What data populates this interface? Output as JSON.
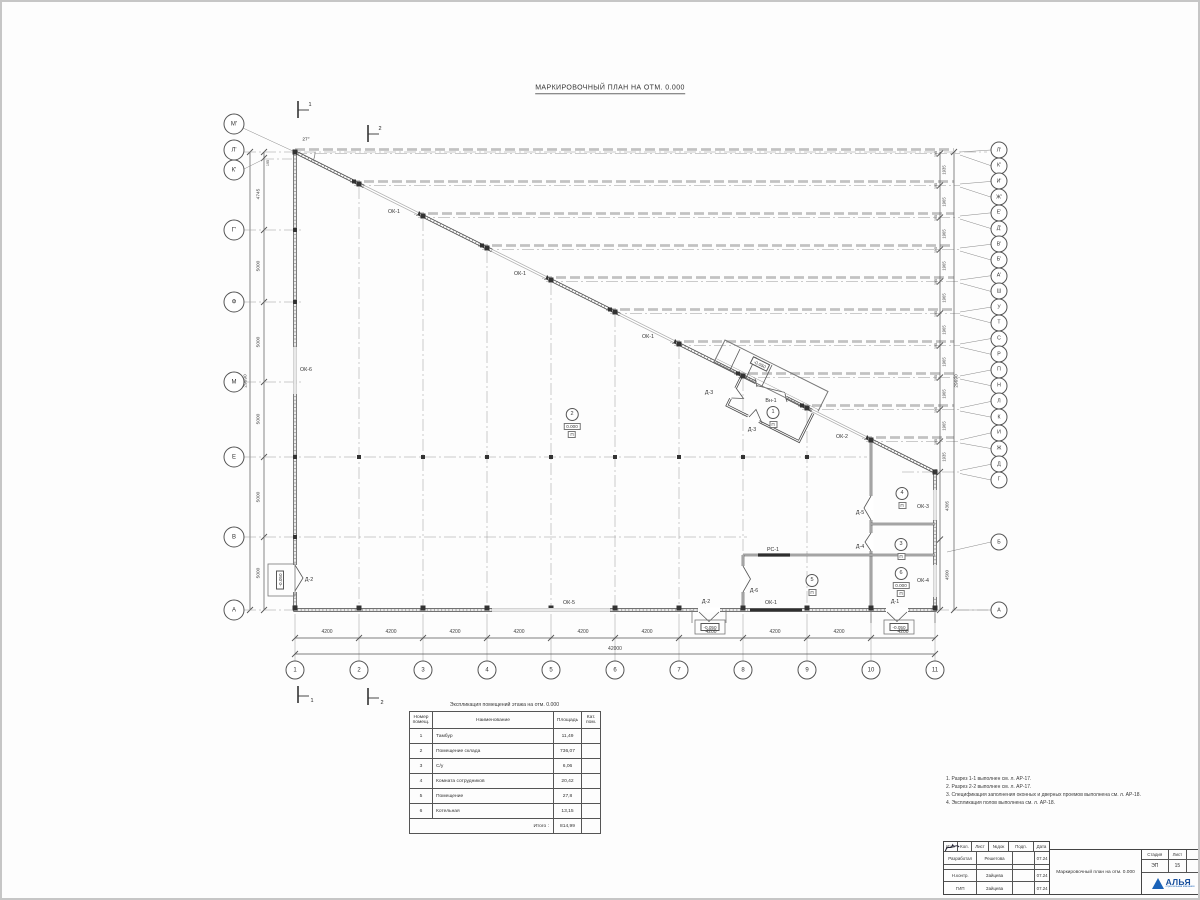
{
  "page": {
    "title": "МАРКИРОВОЧНЫЙ ПЛАН НА ОТМ. 0.000"
  },
  "plan": {
    "angle": "27°",
    "section_mark_1": "1",
    "section_mark_2": "2",
    "axes_left": [
      "М'",
      "Л'",
      "К'",
      "Г'",
      "Ф",
      "М",
      "Е",
      "В",
      "А"
    ],
    "axes_right": [
      "Л'",
      "К'",
      "И'",
      "Ж'",
      "Е'",
      "Д'",
      "В'",
      "Б'",
      "А'",
      "Ш",
      "У",
      "Т",
      "С",
      "Р",
      "П",
      "Н",
      "Л",
      "К",
      "И",
      "Ж",
      "Д",
      "Г",
      "Б",
      "А"
    ],
    "axes_bottom": [
      "1",
      "2",
      "3",
      "4",
      "5",
      "6",
      "7",
      "8",
      "9",
      "10",
      "11"
    ],
    "dims_bottom": [
      "4200",
      "4200",
      "4200",
      "4200",
      "4200",
      "4200",
      "4200",
      "4200",
      "4200",
      "4200"
    ],
    "dim_bottom_total": "42000",
    "dims_left": [
      "195",
      "4745",
      "5000",
      "5000",
      "5000",
      "5000",
      "5000"
    ],
    "dim_left_total": "29690",
    "dims_right_small": [
      "195",
      "195",
      "195",
      "195",
      "195",
      "195",
      "195",
      "195",
      "195",
      "195",
      "195"
    ],
    "dims_right_gaps": [
      "1935",
      "1965",
      "1965",
      "1965",
      "1965",
      "1965",
      "1965",
      "1965",
      "1965",
      "1935"
    ],
    "dims_right_lower": [
      "4305",
      "4500"
    ],
    "dim_right_total": "29690",
    "openings": {
      "ok1": "ОК-1",
      "ok2": "ОК-2",
      "ok3": "ОК-3",
      "ok4": "ОК-4",
      "ok5": "ОК-5",
      "ok6": "ОК-6",
      "rs1": "РС-1",
      "vn1": "Вн-1",
      "d1": "Д-1",
      "d2": "Д-2",
      "d3": "Д-3",
      "d4": "Д-4",
      "d5": "Д-5",
      "d6": "Д-6"
    },
    "levels": {
      "zero": "0.000",
      "low": "-0.050"
    },
    "rooms": {
      "r1": "1",
      "r2": "2",
      "r3": "3",
      "r4": "4",
      "r5": "5",
      "r6": "6",
      "floor": "П"
    }
  },
  "explication": {
    "title": "Экспликация помещений этажа на отм. 0.000",
    "headers": [
      "Номер помещ.",
      "Наименование",
      "Площадь",
      "Кат. пом."
    ],
    "rows": [
      [
        "1",
        "Тамбур",
        "11,49",
        ""
      ],
      [
        "2",
        "Помещение склада",
        "736,07",
        ""
      ],
      [
        "3",
        "С/у",
        "6,06",
        ""
      ],
      [
        "4",
        "Комната сотрудников",
        "20,42",
        ""
      ],
      [
        "5",
        "Помещение",
        "27,8",
        ""
      ],
      [
        "6",
        "Котельная",
        "13,15",
        ""
      ]
    ],
    "total_label": "Итого :",
    "total": "814,99"
  },
  "notes": [
    "1. Разрез 1-1 выполнен см. л. АР-17.",
    "2. Разрез 2-2 выполнен см. л. АР-17.",
    "3. Спецификация заполнения оконных и дверных проемов выполнена см. л. АР-18.",
    "4. Экспликация полов выполнена см. л. АР-18."
  ],
  "titleblock": {
    "headers": [
      "Изм.",
      "Кол.",
      "Лист",
      "№док",
      "Подп.",
      "Дата"
    ],
    "rows": [
      {
        "role": "Разработал",
        "name": "Решетова",
        "date": "07.24"
      },
      {
        "role": "Н.контр.",
        "name": "Зайцева",
        "date": "07.24"
      },
      {
        "role": "ГИП",
        "name": "Зайцева",
        "date": "07.24"
      }
    ],
    "doc_title": "Маркировочный план на отм. 0.000",
    "stage_label": "Стадия",
    "sheet_label": "Лист",
    "stage": "ЭП",
    "sheet": "15",
    "logo_text": "АЛЬЯ",
    "logo_sub": "строительная компания"
  }
}
